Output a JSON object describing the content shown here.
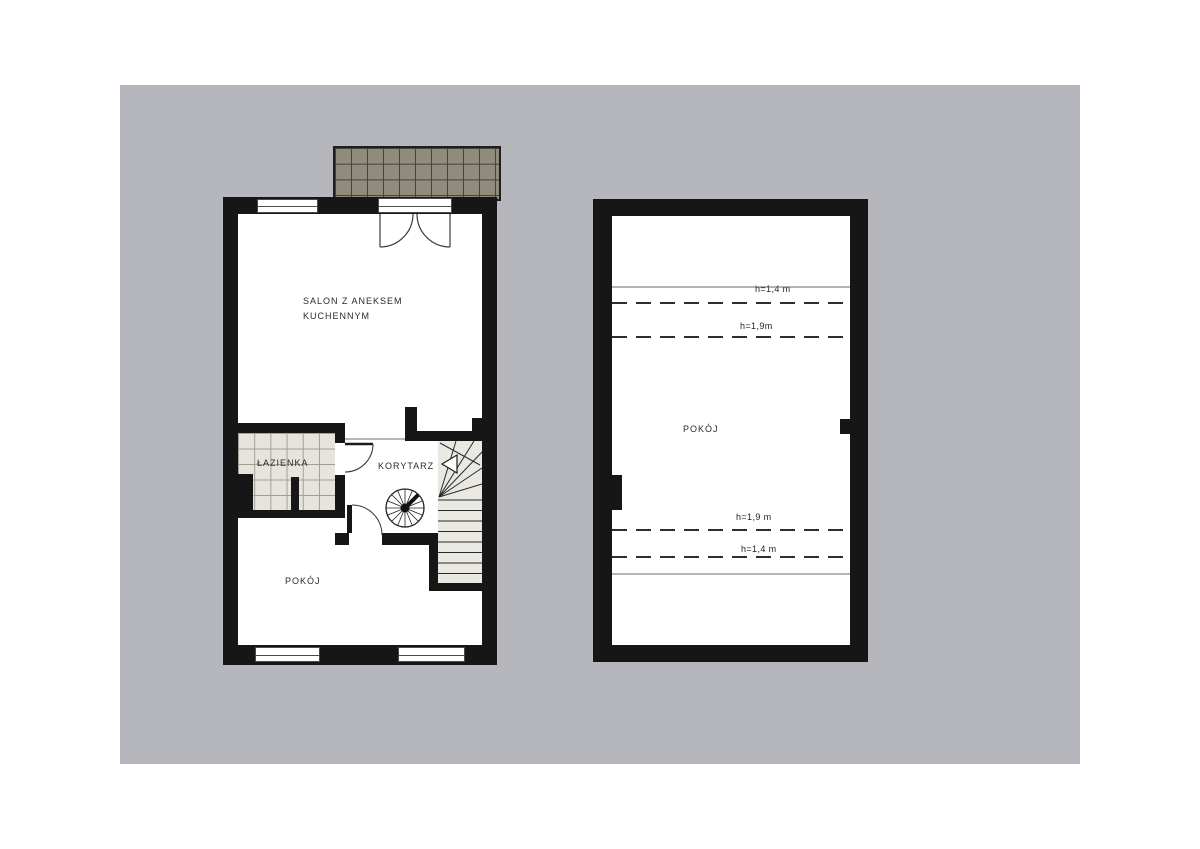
{
  "page": {
    "background_color": "#b6b6bd",
    "type_note": "two-level apartment floor plan"
  },
  "left_plan": {
    "salon_label_line1": "SALON Z ANEKSEM",
    "salon_label_line2": "KUCHENNYM",
    "bathroom_label": "ŁAZIENKA",
    "corridor_label": "KORYTARZ",
    "room_label": "POKÓJ"
  },
  "right_plan": {
    "room_label": "POKÓJ",
    "height_annotations": [
      {
        "label": "h=1,4 m"
      },
      {
        "label": "h=1,9m"
      },
      {
        "label": "h=1,9 m"
      },
      {
        "label": "h=1,4 m"
      }
    ]
  },
  "colors": {
    "wall": "#161616",
    "terrace_tile": "#8f8c7d",
    "bathroom_tile": "#e7e4dd",
    "stair_fill": "#eae8e3",
    "line": "#333333"
  }
}
